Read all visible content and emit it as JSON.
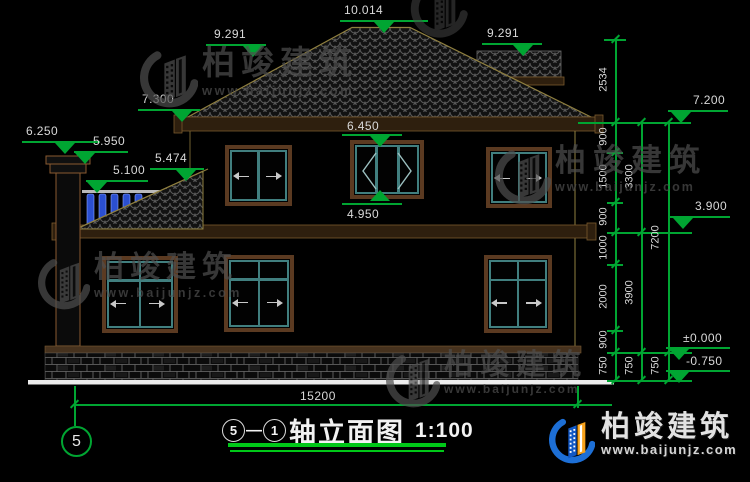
{
  "drawing": {
    "title": {
      "axis_from": "5",
      "separator": "—",
      "axis_to": "1",
      "name": "轴立面图",
      "scale": "1:100"
    },
    "axis_bubble_label": "5",
    "elevations": {
      "ridge": "10.014",
      "eave_left": "9.291",
      "eave_right": "9.291",
      "porch_eave": "7.300",
      "chimney_top": "6.250",
      "chimney_cap": "5.950",
      "railing_top": "5.100",
      "shed_roof": "5.474",
      "window_head": "6.450",
      "window_sill": "4.950",
      "right_eave": "7.200",
      "second_floor": "3.900",
      "first_floor": "±0.000",
      "ground": "-0.750"
    },
    "dimensions": {
      "total_width": "15200",
      "chain_inner": [
        "2534",
        "900",
        "1500",
        "900",
        "1000",
        "2000",
        "900",
        "750"
      ],
      "chain_mid": [
        "3300",
        "3900",
        "750"
      ],
      "chain_outer": [
        "7200",
        "750"
      ]
    }
  },
  "watermark": {
    "name": "柏竣建筑",
    "url": "www.baijunjz.com"
  },
  "brand": {
    "name": "柏竣建筑",
    "url": "www.baijunjz.com"
  },
  "colors": {
    "dimension_green": "#00a532",
    "frame_brown": "#5b3a21",
    "window_teal": "#417f7f",
    "baluster_blue": "#2b4fd0",
    "brand_blue": "#1d6fd6",
    "brand_orange": "#f7a21b"
  }
}
